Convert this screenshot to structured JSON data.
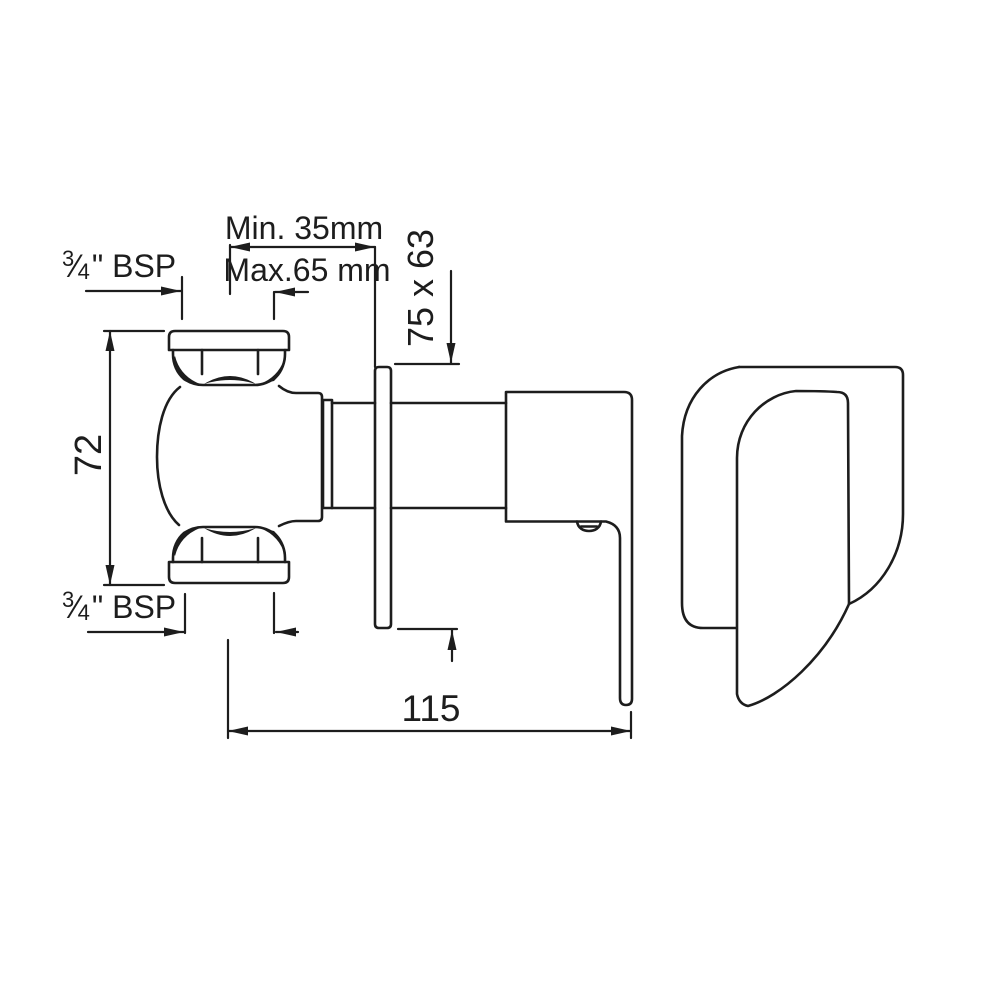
{
  "colors": {
    "background": "#ffffff",
    "line": "#1d1d1d"
  },
  "labels": {
    "min_depth": "Min. 35mm",
    "max_depth": "Max.65 mm",
    "top_thread": {
      "num": "3",
      "den": "4",
      "rest": "\" BSP"
    },
    "bottom_thread": {
      "num": "3",
      "den": "4",
      "rest": "\" BSP"
    },
    "body_height": "72",
    "plate_size": "75 x 63",
    "overall_depth": "115"
  }
}
